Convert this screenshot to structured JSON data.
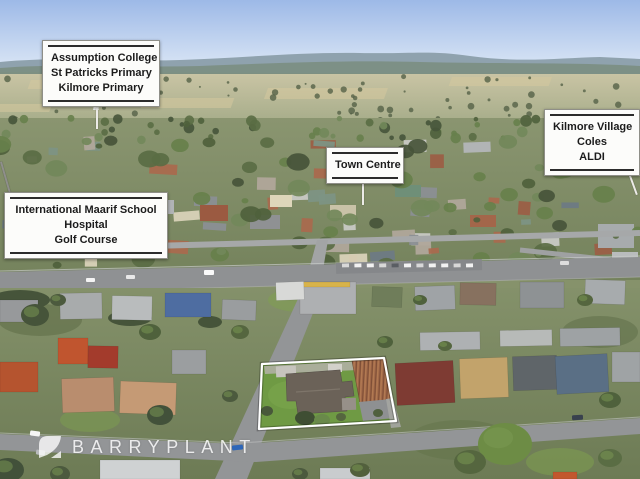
{
  "callouts": {
    "schools": {
      "lines": [
        "Assumption College",
        "St Patricks Primary",
        "Kilmore Primary"
      ]
    },
    "town_centre": {
      "lines": [
        "Town Centre"
      ]
    },
    "shops": {
      "lines": [
        "Kilmore Village",
        "Coles",
        "ALDI"
      ]
    },
    "amenities": {
      "lines": [
        "International Maarif School",
        "Hospital",
        "Golf Course"
      ]
    }
  },
  "watermark": {
    "brand": "BARRYPLANT"
  },
  "colors": {
    "sky_top": "#9db9e7",
    "sky_horizon": "#dde8f6",
    "hills_far": "#8fa2ae",
    "hills_near": "#7c8f84",
    "field_top": "#c9c4a4",
    "field_bottom": "#a4ab88",
    "town_top": "#8a9570",
    "town_bottom": "#74825c",
    "fore_top": "#84916a",
    "fore_bottom": "#6d7b55",
    "road": "#8f9193",
    "street": "#939597",
    "property_lawn": "#6f9a44",
    "boundary": "#ffffff",
    "callout_bg": "#fcfcfa",
    "callout_rule": "#2c2c2c",
    "watermark_white": "#ffffff"
  }
}
